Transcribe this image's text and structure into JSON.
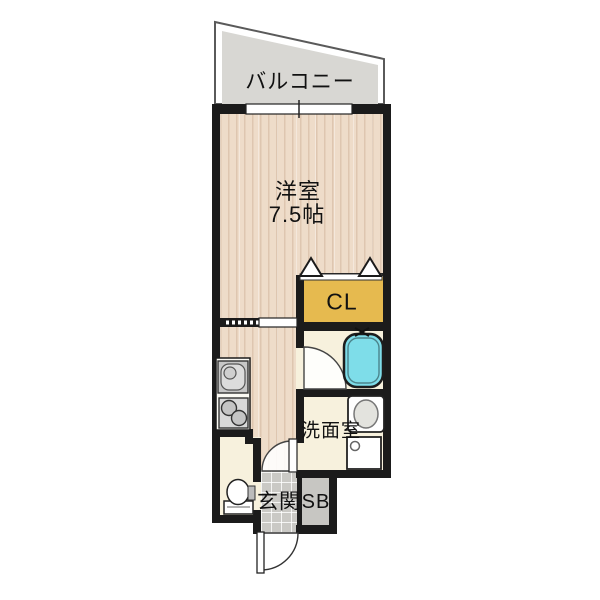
{
  "floorplan": {
    "labels": {
      "balcony": "バルコニー",
      "western_room": "洋室",
      "western_room_size": "7.5帖",
      "closet": "CL",
      "washroom": "洗面室",
      "entrance": "玄関",
      "shoe_box": "SB"
    },
    "colors": {
      "wall": "#1b1b1b",
      "wood_floor": "#eedcc9",
      "cream_floor": "#f7f1dd",
      "closet_fill": "#e6ba4f",
      "balcony_fill": "#d8d7d3",
      "bathtub": "#7edde9",
      "entrance_tile": "#cac9c5",
      "shoe_box_fill": "#c7c6c2",
      "text": "#111111"
    },
    "fixtures": {
      "bathtub": "bathtub-icon",
      "bathtub_faucet": "faucet-icon",
      "vanity_basin": "vanity-basin-icon",
      "washing_machine_pan": "washing-machine-pan-icon",
      "kitchen_sink": "kitchen-sink-icon",
      "stove": "stove-burners-icon",
      "toilet": "toilet-icon",
      "closet_folding_door": "folding-door-icon",
      "window": "sliding-window-icon",
      "room_sliding_door": "sliding-door-icon",
      "bathroom_door": "door-swing-icon",
      "hall_door": "door-swing-icon",
      "entrance_door": "door-swing-icon"
    }
  }
}
